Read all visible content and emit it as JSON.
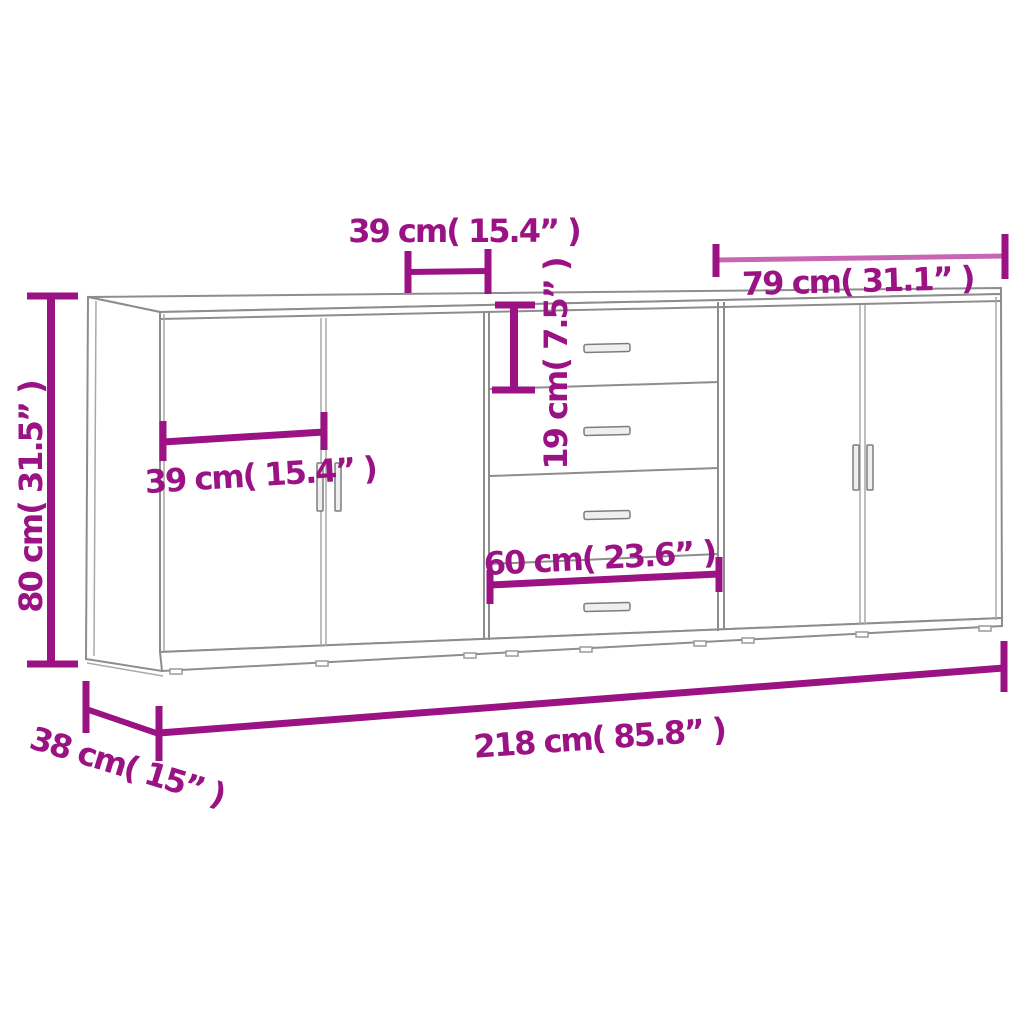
{
  "diagram": {
    "kind": "furniture-dimension-diagram",
    "subject": "Three sideboards shown in perspective line drawing with measurements",
    "colors": {
      "dimension_dark": "#9a1283",
      "dimension_light": "#c767b4",
      "furniture_outline": "#8d8d8d",
      "background": "#ffffff"
    },
    "labels": {
      "overall_height": "80 cm( 31.5” )",
      "top_door_width": "39 cm( 15.4” )",
      "left_door_width": "39 cm( 15.4” )",
      "drawer_height": "19 cm( 7.5” )",
      "middle_unit_width": "60 cm( 23.6” )",
      "right_unit_width": "79 cm( 31.1” )",
      "total_width": "218 cm( 85.8” )",
      "depth": "38 cm( 15” )"
    },
    "units": [
      {
        "id": "left-sideboard",
        "features": "two doors with vertical bar handles"
      },
      {
        "id": "middle-sideboard",
        "features": "four drawers with horizontal bar handles"
      },
      {
        "id": "right-sideboard",
        "features": "two doors with vertical bar handles"
      }
    ]
  }
}
